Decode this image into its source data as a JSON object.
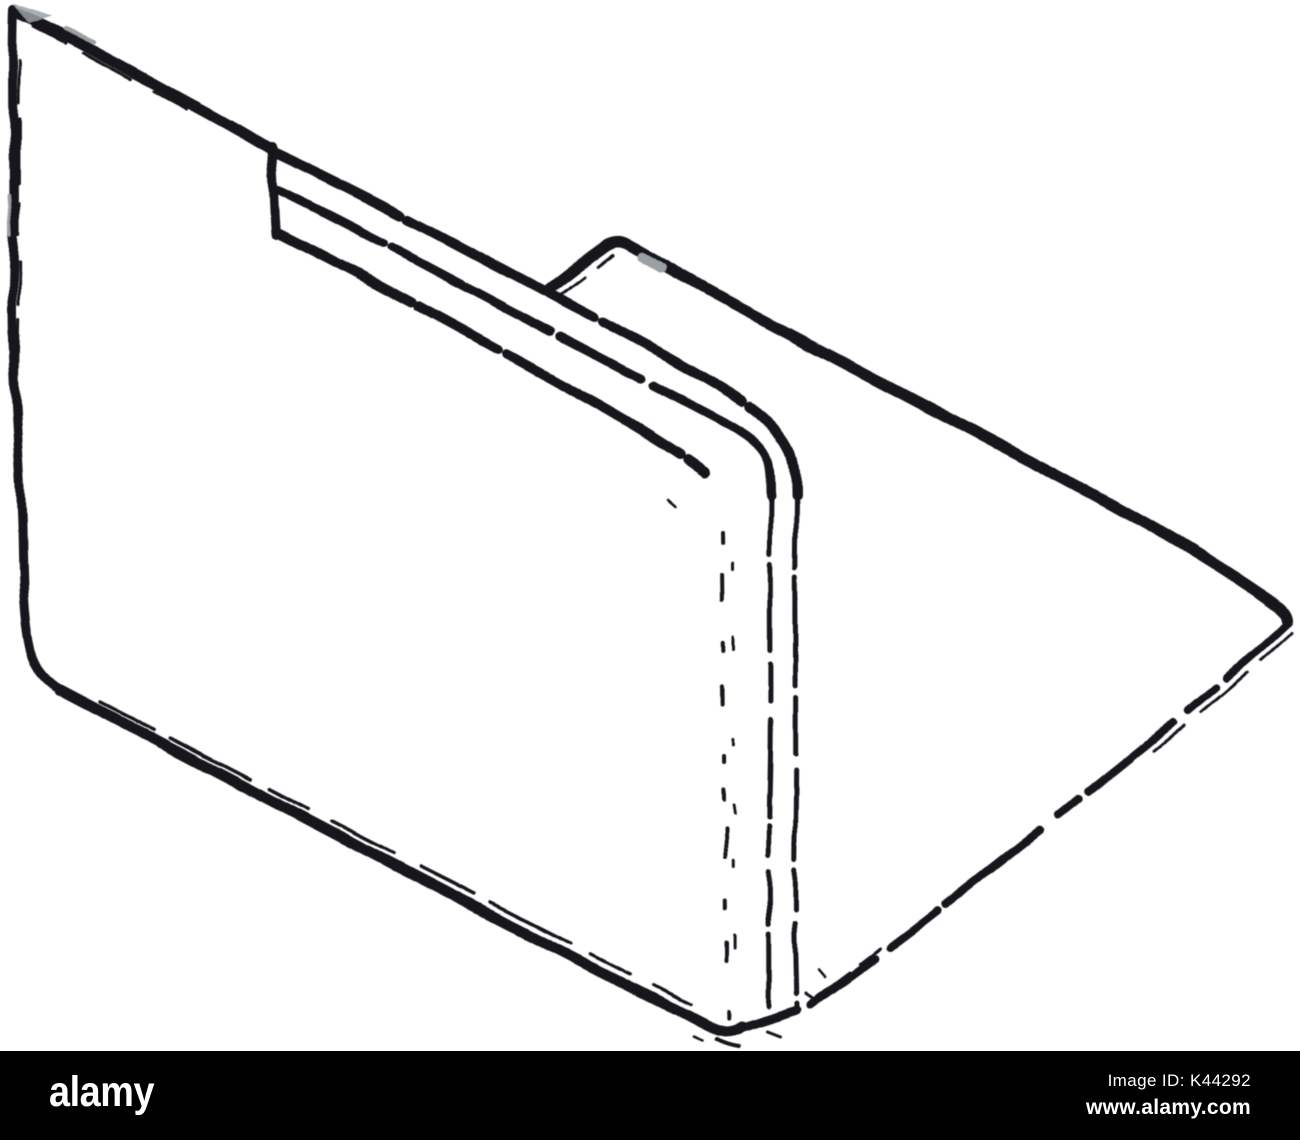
{
  "illustration": {
    "subject": "Open file folder with documents, blurred hand-drawn silhouette sketch, isometric view"
  },
  "colors": {
    "page_background": "#ffffff",
    "ink": "#14171a",
    "smudge": "#9aa0a4",
    "footer_background": "#000000",
    "footer_text": "#ffffff"
  },
  "footer": {
    "brand": "alamy",
    "image_id": "Image ID: K44292",
    "website": "www.alamy.com"
  }
}
